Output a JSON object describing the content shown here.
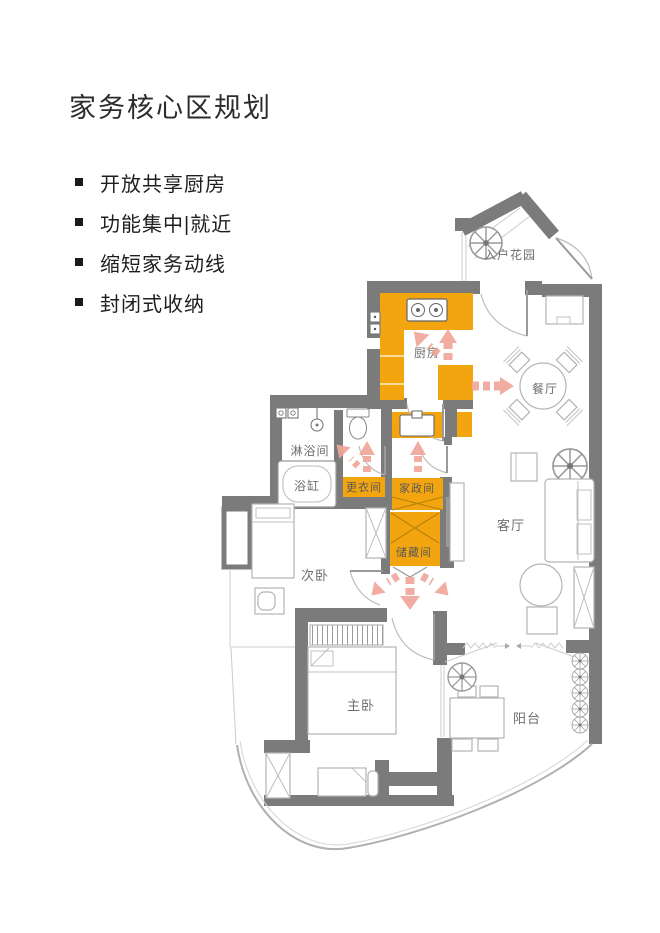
{
  "title": "家务核心区规划",
  "bullets": [
    "开放共享厨房",
    "功能集中|就近",
    "缩短家务动线",
    "封闭式收纳"
  ],
  "floorplan": {
    "rooms": {
      "entry_garden": "入户花园",
      "kitchen": "厨房",
      "dining": "餐厅",
      "shower": "淋浴间",
      "bathtub": "浴缸",
      "dressing": "更衣间",
      "housekeeping": "家政间",
      "storage": "储藏间",
      "living": "客厅",
      "bedroom_second": "次卧",
      "bedroom_master": "主卧",
      "balcony": "阳台"
    },
    "highlight_zones": [
      "厨房",
      "更衣间",
      "家政间",
      "储藏间"
    ],
    "flow_arrows": [
      {
        "from": "厨房",
        "directions": [
          "up",
          "up-left",
          "right"
        ]
      },
      {
        "from": "更衣间",
        "directions": [
          "up",
          "up-left"
        ]
      },
      {
        "from": "家政间",
        "directions": [
          "up"
        ]
      },
      {
        "from": "储藏间",
        "directions": [
          "down-left",
          "down",
          "down-right"
        ]
      }
    ],
    "colors": {
      "wall": "#7b7b7b",
      "highlight": "#F2A50F",
      "arrow": "#F0A79B",
      "furniture_line": "#b4b4b4",
      "label_text": "#6e6e6e"
    },
    "fixtures": [
      "stove-icon",
      "washing-machine-icon",
      "shower-icon",
      "toilet-icon",
      "bathtub-icon",
      "basin-icon",
      "plant-icon",
      "dining-table-icon",
      "sofa-icon",
      "bed-icon",
      "tv-cabinet-icon",
      "wardrobe-icon"
    ]
  }
}
